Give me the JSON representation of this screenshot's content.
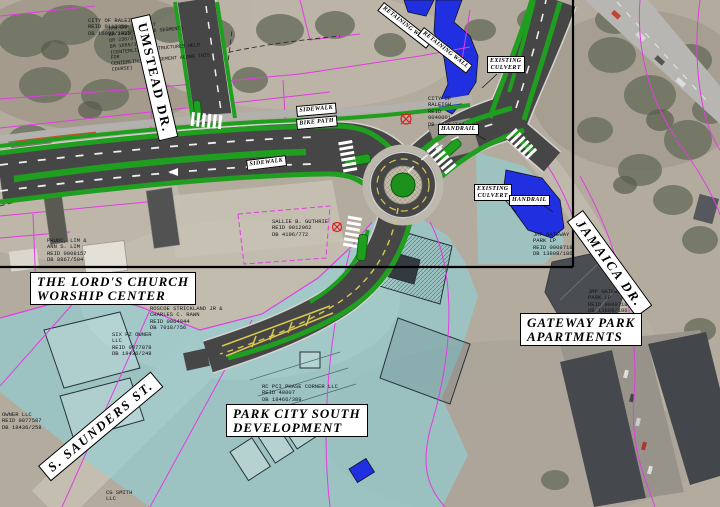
{
  "title": "Roadway improvement plan sheet over aerial photo",
  "streets": {
    "umstead": "UMSTEAD  DR.",
    "jamaica": "JAMAICA  DR.",
    "saunders": "S. SAUNDERS  ST."
  },
  "places": {
    "church": "THE LORD'S CHURCH\nWORSHIP CENTER",
    "gateway": "GATEWAY PARK\nAPARTMENTS",
    "park_city": "PARK CITY SOUTH\nDEVELOPMENT"
  },
  "callouts": {
    "existing_culvert": "EXISTING\nCULVERT",
    "handrail": "HANDRAIL",
    "retaining_wall": "RETAINING WALL",
    "sidewalk": "SIDEWALK",
    "bike_path": "BIKE PATH"
  },
  "parcels": {
    "city_raleigh_1": "CITY OF RALEIGH\nREID 0113250\nDB 16095/1482",
    "easement": "TPW OSP EASEMENT\nBM 2013/588 (3RD SEGMENT)\nDR 238/4\nBM 1885/108\n(CENTERLINE OF STRUCTURES HELD FOR\nCENTERLINE OF EASEMENT ALONG THIS\nCOURSE)",
    "phuoc_lim": "PHUOC, LIM &\nANN S. LIM\nREID 0008157\nDB 8867/504",
    "sallie_guthrie": "SALLIE B. GUTHRIE\nREID 0012962\nDB 4196/772",
    "roscoe": "ROSCOE STRICKLAND JR &\nCHARLES C. RAWN\nREID 0064044\nDB 7018/756",
    "city_raleigh_2": "CITY OF\nRALEIGH\nREID\n0040001\nDB 4596/744",
    "jmp_gateway_1": "JMP GATEWAY\nPARK LP\nREID 0008718\nDB 13808/186",
    "jmp_gateway_2": "JMP GATEWAY\nPARK LP\nREID 0008718\nDB 13808/186",
    "six_pz": "SIX PZ OWNER\nLLC\nREID 0077078\nDB 18436/248",
    "owner_left": "OWNER LLC\nREID 0077587\nDB 18436/258",
    "rc_pci": "RC PCI PHASE CORNER LLC\nREID 48007\nDB 18466/389",
    "cg_smith": "CG SMITH\nLLC"
  },
  "colors": {
    "proposed_green": "#1f9e1f",
    "road_gray": "#464646",
    "water_blue": "#2030e0",
    "flood_cyan": "#8ed2d8",
    "row_magenta": "#e23ce2",
    "matchline_black": "#000000",
    "marking_yellow": "#d9c94e"
  }
}
